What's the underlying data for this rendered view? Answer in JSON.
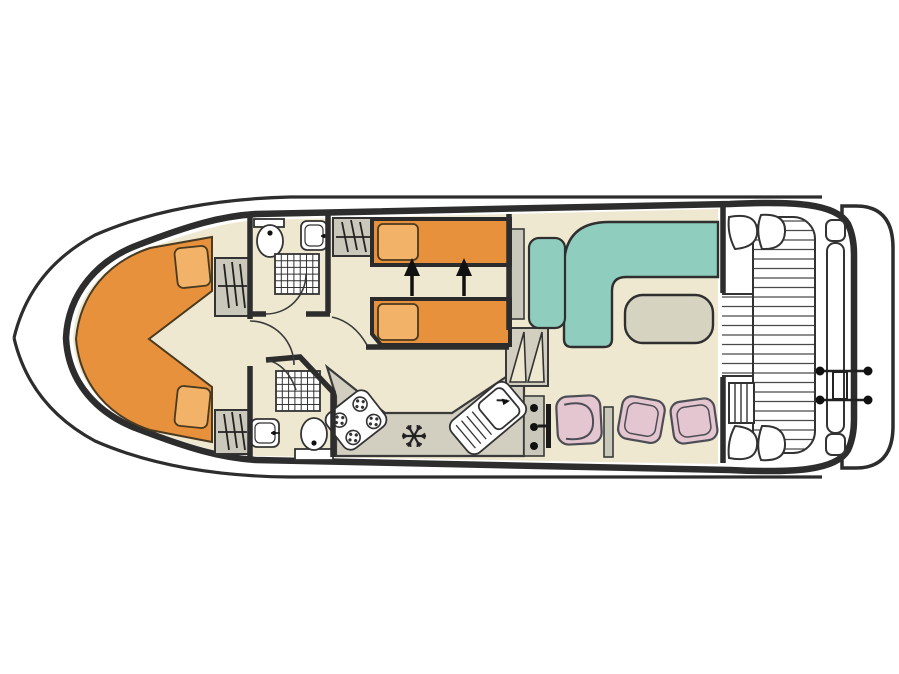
{
  "meta": {
    "type": "boat-deck-plan",
    "description": "Top-down deck plan of a canal cruiser houseboat, bow pointing left",
    "visible_text": []
  },
  "palette": {
    "line": "#2d2d2d",
    "floor": "#efe8d1",
    "counter": "#d2cfc1",
    "cabinet": "#cac8ba",
    "bed_orange": "#e8913c",
    "pillow_orange": "#f2b267",
    "sofa_teal": "#8fcdbf",
    "table_beige": "#d7d3c1",
    "seat_pink": "#e4c6d0",
    "white": "#ffffff"
  },
  "rooms": [
    {
      "id": "bow-cabin",
      "name": "Bow cabin",
      "features": [
        "V-shaped double berth",
        "2 pillows",
        "2 wardrobes"
      ]
    },
    {
      "id": "bathroom-top",
      "name": "Forward bathroom (port)",
      "features": [
        "toilet",
        "washbasin",
        "shower"
      ]
    },
    {
      "id": "bathroom-bottom",
      "name": "Forward bathroom (starboard)",
      "features": [
        "toilet",
        "washbasin",
        "shower"
      ]
    },
    {
      "id": "mid-cabin",
      "name": "Middle cabin",
      "features": [
        "2 single beds convertible to double",
        "2 pillows",
        "wardrobe",
        "2 conversion arrows"
      ]
    },
    {
      "id": "galley",
      "name": "Galley",
      "features": [
        "4-burner hob",
        "refrigerator (snowflake symbol)",
        "sink with drainer",
        "worktop"
      ]
    },
    {
      "id": "salon",
      "name": "Salon",
      "features": [
        "L-shaped sofa",
        "armchair",
        "table",
        "sideboard"
      ]
    },
    {
      "id": "helm",
      "name": "Helm station",
      "features": [
        "instrument console",
        "steering wheel",
        "helm seat",
        "2 stools",
        "hanging locker"
      ]
    },
    {
      "id": "aft-deck",
      "name": "Aft deck",
      "features": [
        "planked walkway",
        "2 corner benches (bow side)",
        "boarding ladder"
      ]
    },
    {
      "id": "stern-platform",
      "name": "Stern platform",
      "features": [
        "rail gate with 4 posts",
        "side step",
        "2 lockers"
      ]
    }
  ]
}
